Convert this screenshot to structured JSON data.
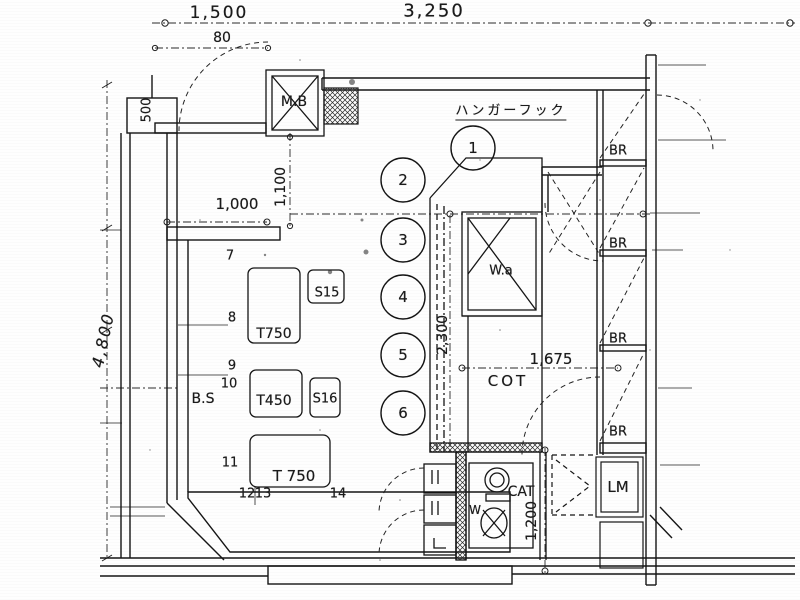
{
  "plan": {
    "sheet_type": "scanned architectural floor plan",
    "dims": {
      "d1500": "1,500",
      "d3250": "3,250",
      "d80": "80",
      "d500": "500",
      "d4800": "4,800",
      "d1000": "1,000",
      "d1100": "1,100",
      "d2300": "2,300",
      "d1675": "1,675",
      "d1200": "1,200"
    },
    "labels": {
      "mb": "M.B",
      "hanger": "ハンガーフック",
      "wa": "W.a",
      "cot": "COT",
      "bs": "B.S",
      "cat": "CAT",
      "w": "W",
      "lm": "LM",
      "br": "BR",
      "t750a": "T750",
      "t450": "T450",
      "t750b": "T 750",
      "s15": "S15",
      "s16": "S16"
    },
    "seats": [
      "1",
      "2",
      "3",
      "4",
      "5",
      "6"
    ],
    "marks": [
      "7",
      "8",
      "9",
      "10",
      "11",
      "12",
      "13",
      "14"
    ],
    "ink_color": "#1b1b1b",
    "paper_color": "#fefefe"
  }
}
